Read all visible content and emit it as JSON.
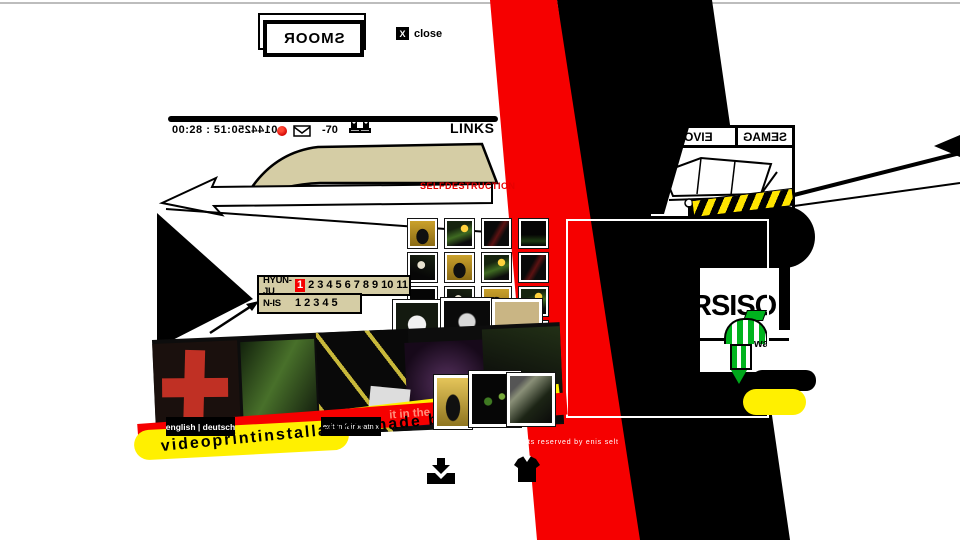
{
  "window": {
    "rooms_mirrored_source": "SMOOR",
    "close_x": "X",
    "close_label": "close"
  },
  "statusbar": {
    "timecode": "00:28 : 51:",
    "counter_mirrored_source": "0144250",
    "level": "-70",
    "links_label": "LINKS"
  },
  "tabs": {
    "movie_mirrored_source": "EIVOM",
    "games_mirrored_source": "SEMAG"
  },
  "warning": {
    "selfdestruction": "SELFDESTRUCTION"
  },
  "navigation": {
    "row1_label": "HYUN-JU",
    "row1_numbers": [
      "1",
      "2",
      "3",
      "4",
      "5",
      "6",
      "7",
      "8",
      "9",
      "10",
      "11"
    ],
    "row1_active": "1",
    "row2_label": "N-IS",
    "row2_numbers": [
      "1",
      "2",
      "3",
      "4",
      "5"
    ]
  },
  "right_panel": {
    "big_text": "RSISO",
    "small_text": "wa"
  },
  "footer": {
    "language_switch": "english | deutsch",
    "project_banner": "project information site of vps",
    "exit_link": "exit in fairbeatnix",
    "chaos_fragment": "it in the chaos o",
    "credit_line": "videoprintinstallation made by",
    "rights_line": "ts reserved by enis selt"
  },
  "colors": {
    "red": "#F60000",
    "yellow": "#FFF000",
    "khaki": "#D5CDA5",
    "hazard": "#FFE400"
  }
}
